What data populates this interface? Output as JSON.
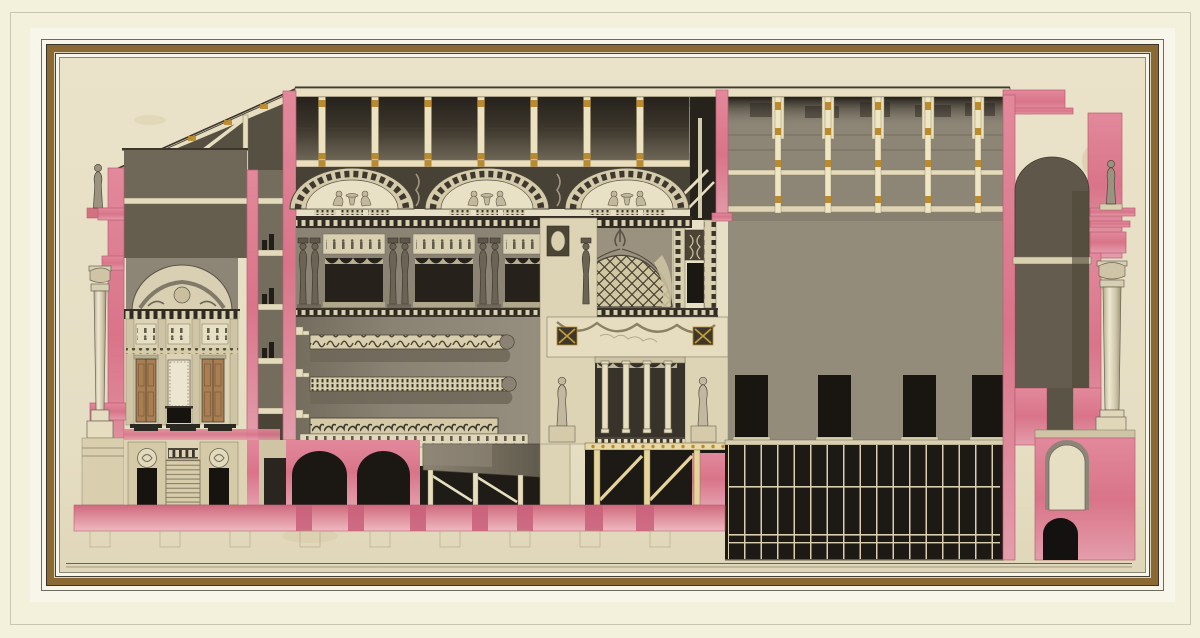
{
  "artwork": {
    "depicts": "Longitudinal section of a neoclassical theater, drawn in pen and gray wash with rose-pink sectional masonry",
    "sections": [
      {
        "name": "entrance-pavilion",
        "label": "Entrance pavilion with portico column, statue and foyer"
      },
      {
        "name": "auditorium",
        "label": "Auditorium with lunette ceiling, caryatid box gallery and balcony tiers"
      },
      {
        "name": "proscenium",
        "label": "Proscenium with coffered canopy, colonnade and flanking statues"
      },
      {
        "name": "stage-house",
        "label": "Stage house with fly galleries and scenery wall"
      },
      {
        "name": "understage",
        "label": "Understage machinery grid"
      },
      {
        "name": "rear-wall",
        "label": "Rear end wall with arched niche, statue and exterior column"
      },
      {
        "name": "foundations",
        "label": "Foundation strip with footing outlines"
      }
    ]
  },
  "palette": {
    "page_cream": "#f3f0dc",
    "mat_white": "#f8f6ea",
    "frame_gold": "#8a6a32",
    "paper_beige": "#e8e0c6",
    "rule_dark": "#8d8876",
    "wash_pink": "#d97489",
    "wash_pink_light": "#eaa9b3",
    "wash_gray": "#948c7b",
    "wash_gray_dark": "#6e6758",
    "attic_dark": "#26221c",
    "ink_black": "#1d1915",
    "stone_cream": "#ddd3b5",
    "timber_gold": "#b98a2e",
    "timber_cream": "#e7d9a8",
    "door_brown": "#a87e52",
    "niche_gray": "#5e574a"
  },
  "frame": {
    "mat": "cream mat with ruled border",
    "band": "gilt fillet between black rules"
  }
}
